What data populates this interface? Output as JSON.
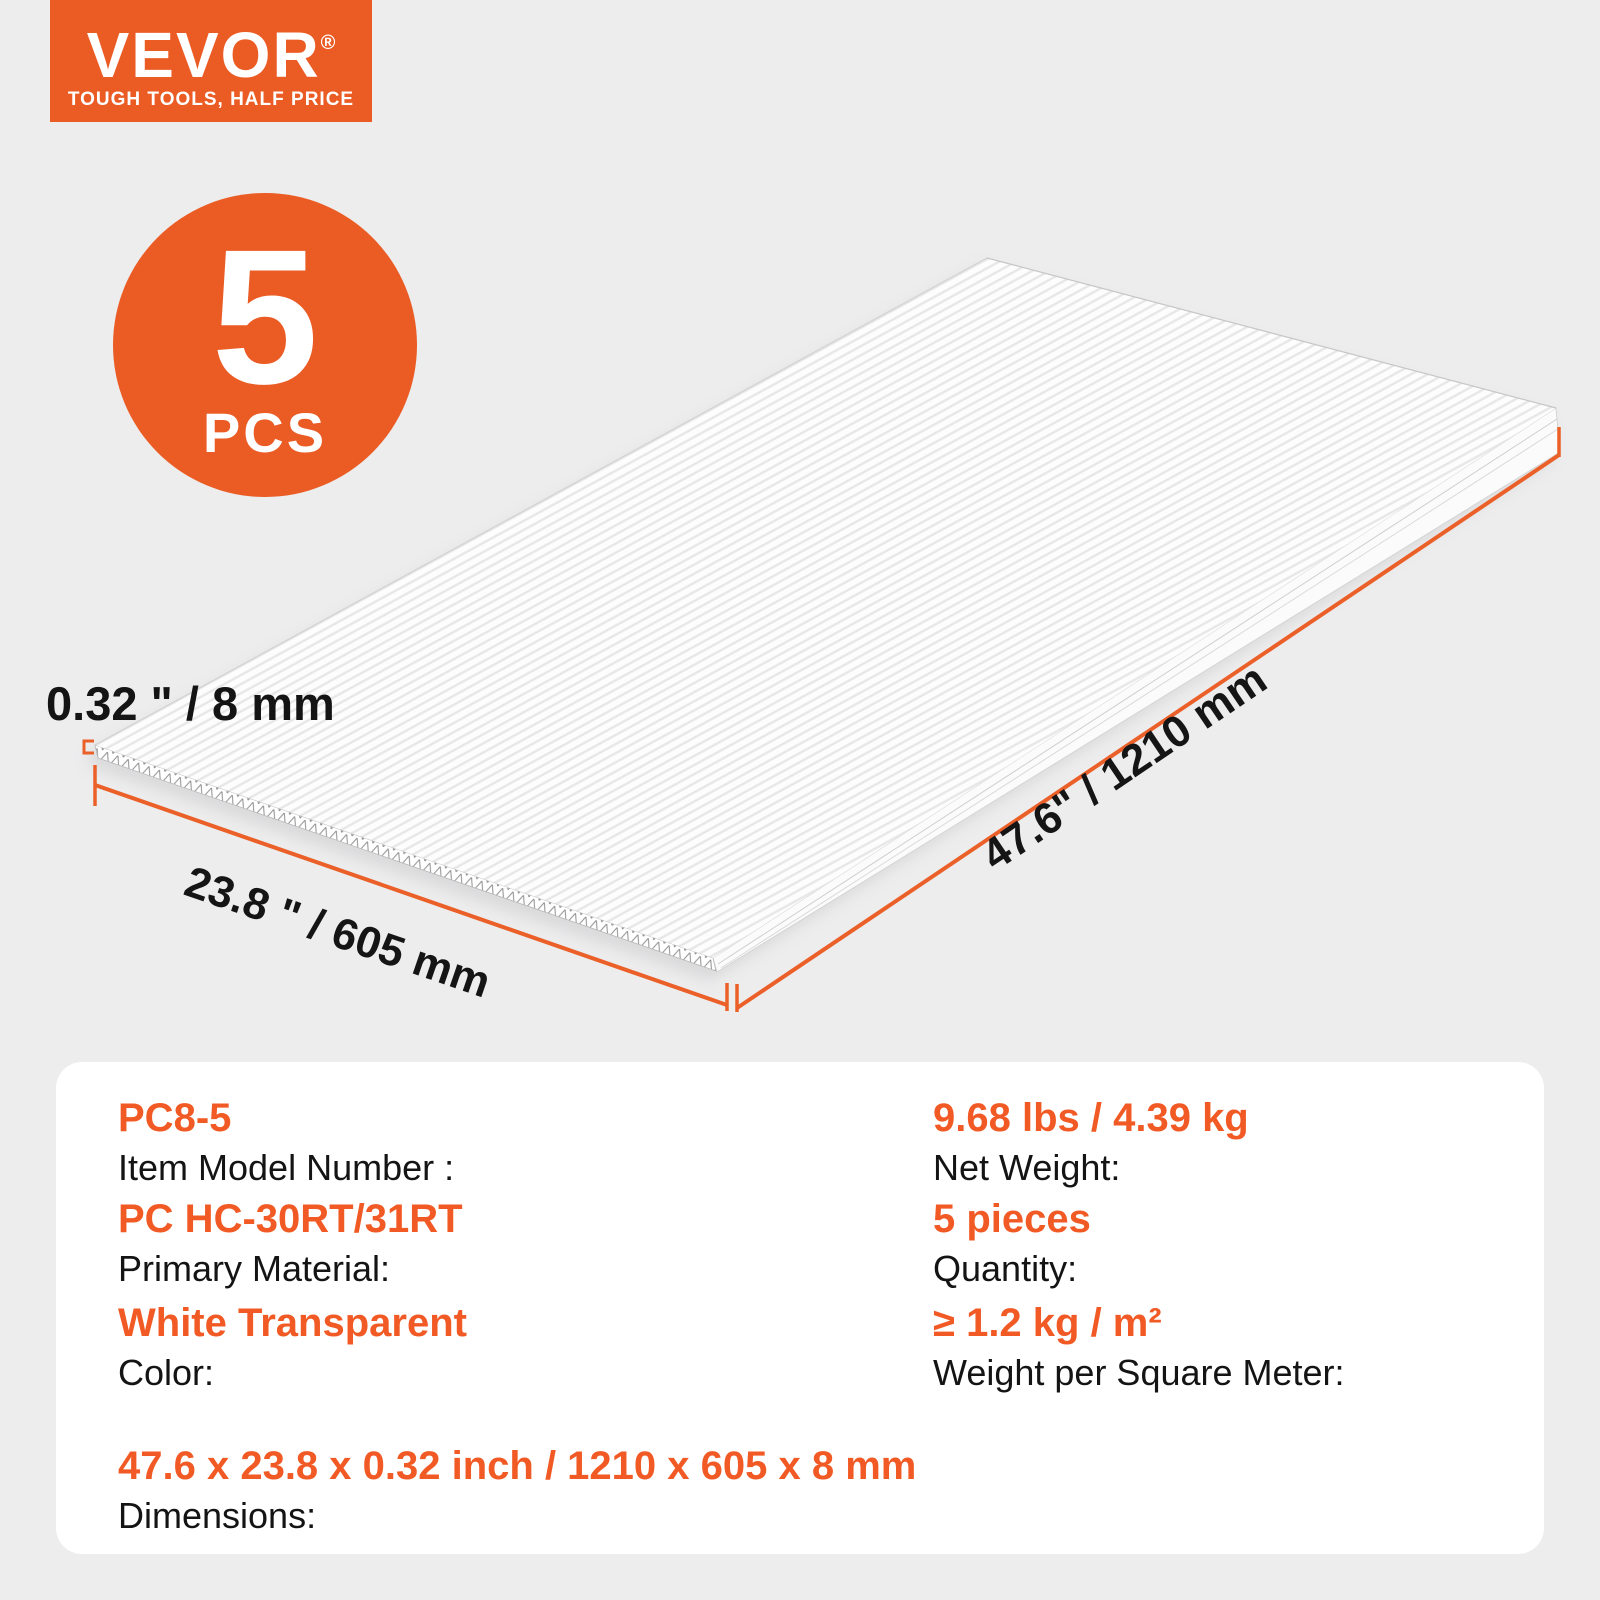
{
  "brand": {
    "logo_text": "VEVOR",
    "registered_mark": "®",
    "tagline": "TOUGH TOOLS, HALF PRICE"
  },
  "badge": {
    "count": "5",
    "unit": "PCS"
  },
  "diagram": {
    "thickness_label": "0.32 \" / 8 mm",
    "width_label": "23.8 \" / 605 mm",
    "length_label": "47.6\" / 1210 mm"
  },
  "specs": {
    "left": [
      {
        "value": "PC8-5",
        "label": "Item Model Number :"
      },
      {
        "value": "PC HC-30RT/31RT",
        "label": "Primary Material:"
      },
      {
        "value": "White Transparent",
        "label": "Color:"
      },
      {
        "value": "47.6 x 23.8 x 0.32 inch / 1210 x 605 x 8 mm",
        "label": "Dimensions:"
      }
    ],
    "right": [
      {
        "value": "9.68 lbs / 4.39 kg",
        "label": "Net Weight:"
      },
      {
        "value": "5 pieces",
        "label": "Quantity:"
      },
      {
        "value": "≥ 1.2 kg / m²",
        "label": "Weight per Square Meter:"
      }
    ]
  },
  "colors": {
    "brand_orange": "#EB5B24",
    "dimension_line_orange": "#EB6028",
    "background_gray": "#EDEDEE",
    "card_white": "#FFFFFF"
  }
}
